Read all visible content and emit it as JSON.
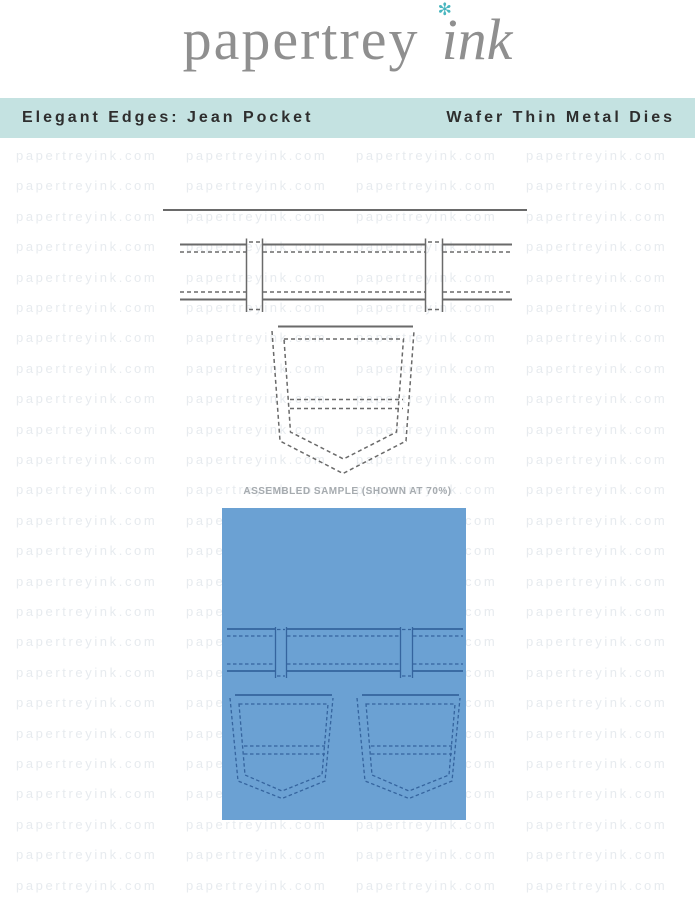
{
  "logo": {
    "brand": "papertrey",
    "suffix": "ink",
    "flower_glyph": "✻"
  },
  "banner": {
    "left_label": "Elegant Edges: Jean Pocket",
    "right_label": "Wafer Thin Metal Dies"
  },
  "watermark": {
    "text": "papertreyink.com"
  },
  "sample": {
    "caption": "ASSEMBLED SAMPLE (SHOWN AT 70%)"
  },
  "colors": {
    "banner_bg": "#c4e2e1",
    "banner_text": "#2e2e2e",
    "logo_gray": "#8f8f8f",
    "flower_teal": "#49b6bf",
    "watermark_gray": "#e7ebef",
    "die_line": "#6a6a6a",
    "denim_blue": "#6ba1d3",
    "stitch_blue": "#35649e",
    "caption_gray": "#a6abaf"
  }
}
